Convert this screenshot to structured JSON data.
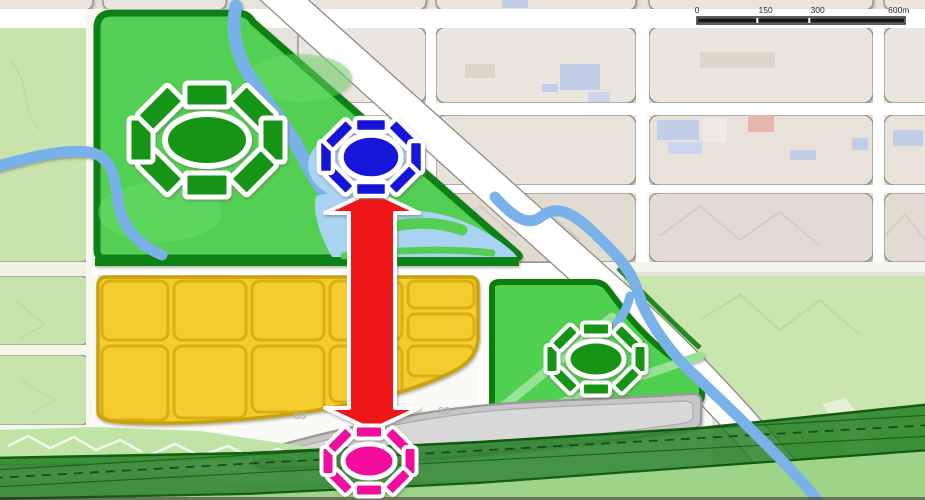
{
  "map": {
    "kind": "urban-planning-concept-map",
    "road_labels": [
      "S3",
      "S3"
    ]
  },
  "colors": {
    "satellite_base": "#E7E2DB",
    "block_fill": "#EAE5DE",
    "block_fill_dark": "#E1DBD1",
    "block_stroke": "#8F8A84",
    "road_white": "#FFFFFF",
    "road_cream": "#F0F2E2",
    "river_blue": "#79B2E8",
    "lake_blue": "#A9D3F1",
    "park_green": "#53D053",
    "park_green_light": "#6ADD6A",
    "park_border": "#0E8113",
    "park_east_green": "#4FD14F",
    "path_light": "#97E297",
    "pale_terrain": "#C8E4AC",
    "terrain_bright": "#BFE4A6",
    "under_band_green": "#9ED487",
    "yellow_fill": "#F5CC2D",
    "yellow_stroke": "#D9AE15",
    "yellow_border": "#C9A30B",
    "gray_fill": "#C6C6C6",
    "gray_inner": "#D8D8D8",
    "gray_stroke": "#9A9A9A",
    "band_green": "#1D7C1D",
    "band_dark": "#0A540A",
    "flower_green": "#149414",
    "flower_blue": "#1414D8",
    "flower_pink": "#F20D9E",
    "arrow_red": "#EE1212",
    "building_blue": "#C2CEE8",
    "building_pink": "#E9B6AE",
    "building_light": "#EFEAE4",
    "scale_black": "#1A1A1A",
    "label_gray": "#B3B7BA",
    "bottom_line": "#3A2A20"
  },
  "scale_bar": {
    "x": 697,
    "y": 17,
    "width": 208,
    "height": 7,
    "labels": [
      {
        "text": "0",
        "frac": 0.0
      },
      {
        "text": "150",
        "frac": 0.33
      },
      {
        "text": "300",
        "frac": 0.58
      },
      {
        "text": "600m",
        "frac": 0.97
      }
    ],
    "segments": [
      [
        0,
        0.29
      ],
      [
        0.29,
        0.54
      ],
      [
        0.54,
        1
      ]
    ]
  },
  "flowers": [
    {
      "name": "green-plaza-flower-large",
      "cx": 207,
      "cy": 140,
      "rx": 42,
      "ry": 26,
      "ringRx": 66,
      "ringRy": 45,
      "petalW": 44,
      "petalH": 24,
      "stroke": 5,
      "color": "flower_green"
    },
    {
      "name": "blue-node-flower",
      "cx": 371,
      "cy": 157,
      "rx": 30,
      "ry": 22,
      "ringRx": 45,
      "ringRy": 32,
      "petalW": 32,
      "petalH": 14,
      "stroke": 4.5,
      "color": "flower_blue"
    },
    {
      "name": "green-plaza-flower-small",
      "cx": 596,
      "cy": 359,
      "rx": 28,
      "ry": 18,
      "ringRx": 44,
      "ringRy": 30,
      "petalW": 28,
      "petalH": 13,
      "stroke": 4,
      "color": "flower_green"
    },
    {
      "name": "pink-node-flower",
      "cx": 369,
      "cy": 461,
      "rx": 26,
      "ry": 17,
      "ringRx": 41,
      "ringRy": 29,
      "petalW": 28,
      "petalH": 13,
      "stroke": 4,
      "color": "flower_pink"
    }
  ],
  "arrow": {
    "x": 372,
    "tipTop": 191,
    "tipBottom": 430,
    "shaftHalf": 23,
    "headHalf": 47,
    "headH": 22,
    "color": "arrow_red"
  }
}
